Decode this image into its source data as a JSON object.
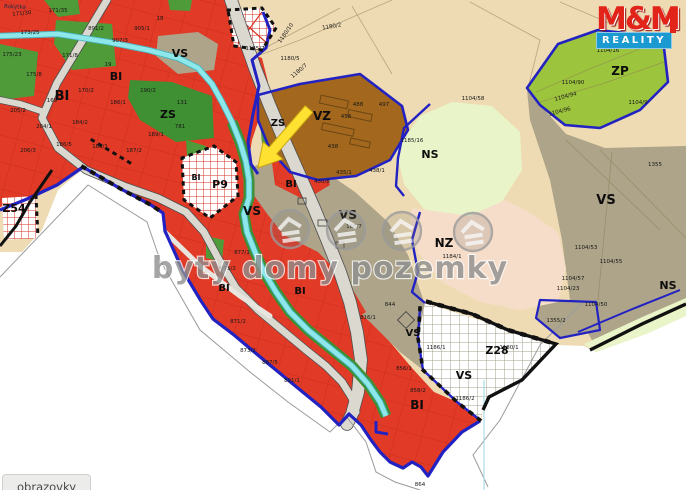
{
  "watermark": {
    "text": "byty domy pozemky"
  },
  "logo": {
    "line1": "M&M",
    "line2": "REALITY"
  },
  "tooltip": {
    "text": "obrazovky"
  },
  "map": {
    "stream_label": "Rokytka",
    "legend_colors": {
      "BI": "#e13a27",
      "ZS": "#4f9b3a",
      "ZS_dark": "#3f8f33",
      "ZP": "#9dc43d",
      "NS": "#e9f4c9",
      "NZ": "#f6ddc9",
      "FIELD": "#eedbb3",
      "VS": "#ada489",
      "VZ": "#a3681e",
      "water": "#8ee8ea",
      "water_edge": "#49b7c4",
      "road": "#dbd8d0",
      "road_edge": "#4f4f4f",
      "boundary": "#2222c2",
      "black_line": "#111111",
      "hatch_red": "#d63326",
      "hatch_gray": "#a59f8f",
      "arrow": "#ffe132"
    },
    "zone_labels": [
      {
        "text": "BI",
        "x": 62,
        "y": 100,
        "s": 13
      },
      {
        "text": "BI",
        "x": 116,
        "y": 80,
        "s": 11
      },
      {
        "text": "BI",
        "x": 196,
        "y": 180,
        "s": 8
      },
      {
        "text": "BI",
        "x": 291,
        "y": 187,
        "s": 10
      },
      {
        "text": "BI",
        "x": 224,
        "y": 291,
        "s": 10
      },
      {
        "text": "BI",
        "x": 300,
        "y": 294,
        "s": 10
      },
      {
        "text": "BI",
        "x": 417,
        "y": 409,
        "s": 12
      },
      {
        "text": "VS",
        "x": 180,
        "y": 57,
        "s": 11
      },
      {
        "text": "VS",
        "x": 252,
        "y": 215,
        "s": 12
      },
      {
        "text": "VS",
        "x": 348,
        "y": 219,
        "s": 12
      },
      {
        "text": "VS",
        "x": 606,
        "y": 204,
        "s": 13
      },
      {
        "text": "VS",
        "x": 413,
        "y": 336,
        "s": 10
      },
      {
        "text": "VS",
        "x": 464,
        "y": 379,
        "s": 11
      },
      {
        "text": "ZS",
        "x": 168,
        "y": 118,
        "s": 11
      },
      {
        "text": "ZS",
        "x": 278,
        "y": 126,
        "s": 10
      },
      {
        "text": "VZ",
        "x": 322,
        "y": 120,
        "s": 12
      },
      {
        "text": "NS",
        "x": 430,
        "y": 158,
        "s": 11
      },
      {
        "text": "NS",
        "x": 668,
        "y": 289,
        "s": 11
      },
      {
        "text": "NZ",
        "x": 444,
        "y": 247,
        "s": 12
      },
      {
        "text": "ZP",
        "x": 620,
        "y": 75,
        "s": 12
      },
      {
        "text": "Z28",
        "x": 497,
        "y": 354,
        "s": 11
      },
      {
        "text": "Z54",
        "x": 14,
        "y": 212,
        "s": 11
      },
      {
        "text": "P9",
        "x": 220,
        "y": 188,
        "s": 11
      }
    ],
    "parcel_labels": [
      {
        "text": "171/30",
        "x": 22,
        "y": 15,
        "r": -6
      },
      {
        "text": "171/35",
        "x": 58,
        "y": 12
      },
      {
        "text": "891/2",
        "x": 96,
        "y": 30
      },
      {
        "text": "173/25",
        "x": 30,
        "y": 34
      },
      {
        "text": "175/23",
        "x": 12,
        "y": 56
      },
      {
        "text": "171/8",
        "x": 70,
        "y": 57
      },
      {
        "text": "175/8",
        "x": 34,
        "y": 76
      },
      {
        "text": "907/3",
        "x": 120,
        "y": 42
      },
      {
        "text": "905/1",
        "x": 142,
        "y": 30
      },
      {
        "text": "18",
        "x": 160,
        "y": 20
      },
      {
        "text": "19",
        "x": 108,
        "y": 66
      },
      {
        "text": "170/2",
        "x": 86,
        "y": 92
      },
      {
        "text": "169",
        "x": 52,
        "y": 102
      },
      {
        "text": "205/2",
        "x": 18,
        "y": 112
      },
      {
        "text": "204/1",
        "x": 44,
        "y": 128
      },
      {
        "text": "184/2",
        "x": 80,
        "y": 124
      },
      {
        "text": "186/1",
        "x": 118,
        "y": 104
      },
      {
        "text": "190/2",
        "x": 148,
        "y": 92
      },
      {
        "text": "186/5",
        "x": 64,
        "y": 146
      },
      {
        "text": "188/1",
        "x": 100,
        "y": 148
      },
      {
        "text": "187/2",
        "x": 134,
        "y": 152
      },
      {
        "text": "206/3",
        "x": 28,
        "y": 152
      },
      {
        "text": "189/1",
        "x": 156,
        "y": 136
      },
      {
        "text": "781",
        "x": 180,
        "y": 128
      },
      {
        "text": "131",
        "x": 182,
        "y": 104
      },
      {
        "text": "1180/10",
        "x": 287,
        "y": 34,
        "r": -55
      },
      {
        "text": "1180/7",
        "x": 300,
        "y": 72,
        "r": -40
      },
      {
        "text": "1185/7",
        "x": 255,
        "y": 50
      },
      {
        "text": "1180/5",
        "x": 290,
        "y": 60
      },
      {
        "text": "1180/2",
        "x": 332,
        "y": 28,
        "r": -10
      },
      {
        "text": "1185/16",
        "x": 412,
        "y": 142
      },
      {
        "text": "488",
        "x": 358,
        "y": 106
      },
      {
        "text": "497",
        "x": 384,
        "y": 106
      },
      {
        "text": "458",
        "x": 346,
        "y": 118
      },
      {
        "text": "438",
        "x": 333,
        "y": 148
      },
      {
        "text": "1104/16",
        "x": 608,
        "y": 52
      },
      {
        "text": "1104/90",
        "x": 573,
        "y": 84
      },
      {
        "text": "1104/9",
        "x": 638,
        "y": 104
      },
      {
        "text": "1104/58",
        "x": 473,
        "y": 100
      },
      {
        "text": "1104/96",
        "x": 560,
        "y": 113,
        "r": -15
      },
      {
        "text": "1104/94",
        "x": 566,
        "y": 98,
        "r": -15
      },
      {
        "text": "1104/53",
        "x": 586,
        "y": 249
      },
      {
        "text": "1104/55",
        "x": 611,
        "y": 263
      },
      {
        "text": "1104/57",
        "x": 573,
        "y": 280
      },
      {
        "text": "1104/23",
        "x": 568,
        "y": 290
      },
      {
        "text": "1104/50",
        "x": 596,
        "y": 306
      },
      {
        "text": "1355",
        "x": 655,
        "y": 166
      },
      {
        "text": "1355/2",
        "x": 556,
        "y": 322
      },
      {
        "text": "1180/1",
        "x": 509,
        "y": 349
      },
      {
        "text": "1186/1",
        "x": 436,
        "y": 349
      },
      {
        "text": "1186/2",
        "x": 465,
        "y": 400
      },
      {
        "text": "871/2",
        "x": 238,
        "y": 323
      },
      {
        "text": "873/2",
        "x": 248,
        "y": 352
      },
      {
        "text": "887/5",
        "x": 270,
        "y": 364
      },
      {
        "text": "891/1",
        "x": 292,
        "y": 382
      },
      {
        "text": "844",
        "x": 390,
        "y": 306
      },
      {
        "text": "816/1",
        "x": 368,
        "y": 319
      },
      {
        "text": "856/1",
        "x": 404,
        "y": 370
      },
      {
        "text": "858/2",
        "x": 418,
        "y": 392
      },
      {
        "text": "864",
        "x": 420,
        "y": 486
      },
      {
        "text": "1184/1",
        "x": 452,
        "y": 258
      },
      {
        "text": "430/8",
        "x": 322,
        "y": 183
      },
      {
        "text": "435/1",
        "x": 344,
        "y": 174
      },
      {
        "text": "438/1",
        "x": 377,
        "y": 172
      },
      {
        "text": "165/7",
        "x": 354,
        "y": 228
      },
      {
        "text": "877/1",
        "x": 242,
        "y": 254
      },
      {
        "text": "875/2",
        "x": 228,
        "y": 270
      }
    ]
  }
}
